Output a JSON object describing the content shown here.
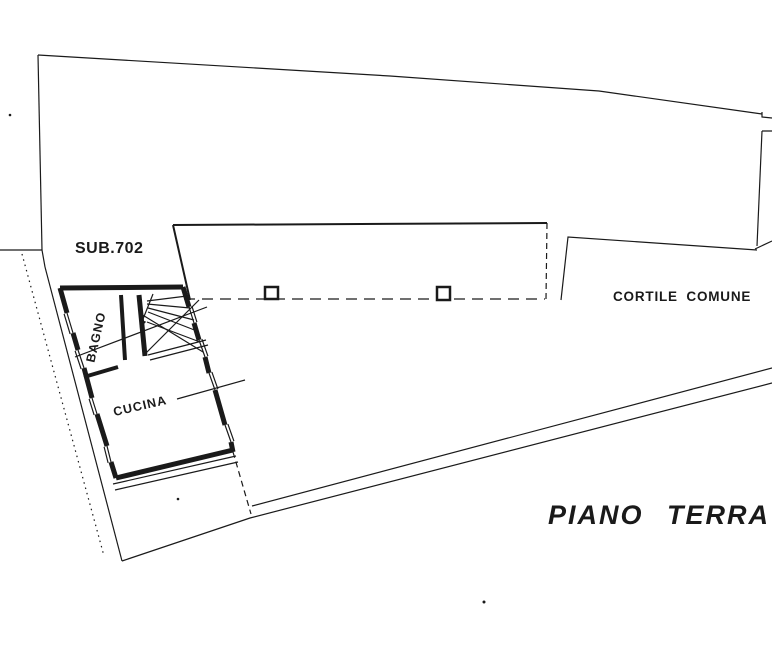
{
  "document": {
    "type": "cadastral-floor-plan",
    "floor_title": "PIANO TERRA"
  },
  "labels": {
    "sub702": "SUB.702",
    "cortile_comune": "CORTILE COMUNE",
    "bagno": "BAGNO",
    "cucina": "CUCINA",
    "piano_terra": "PIANO TERRA"
  },
  "rooms": [
    {
      "name": "BAGNO"
    },
    {
      "name": "CUCINA"
    }
  ],
  "features": {
    "unit_id": "SUB.702",
    "courtyard": "CORTILE COMUNE",
    "pillars_on_courtyard_line": 2,
    "staircase": "winder stairs with direction arrow",
    "windows_left_wall": 4,
    "windows_right_wall": 4
  },
  "colors": {
    "ink": "#1a1a1a",
    "paper": "#ffffff"
  }
}
